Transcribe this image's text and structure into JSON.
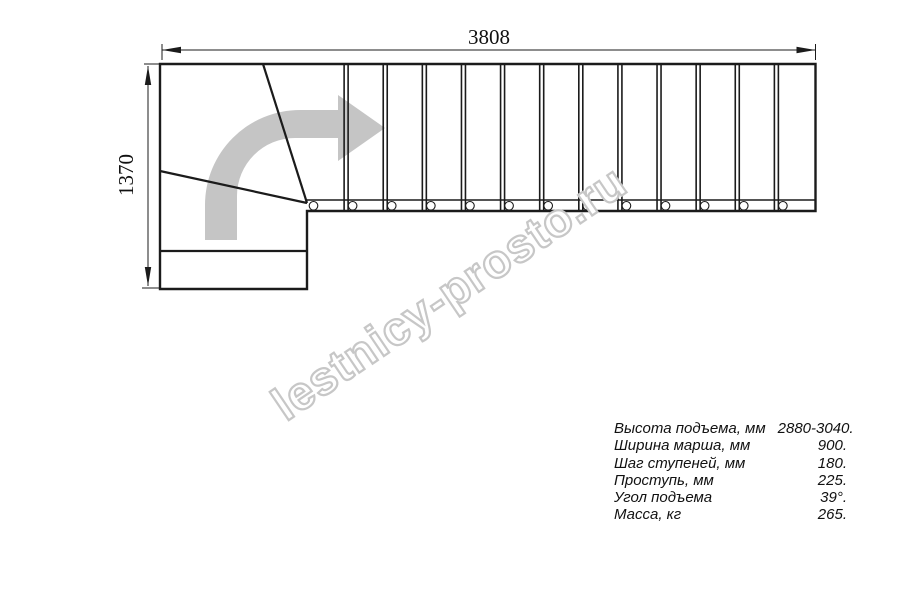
{
  "drawing": {
    "dim_width_label": "3808",
    "dim_height_label": "1370",
    "straight_steps": 13,
    "colors": {
      "line": "#1b1b1b",
      "arrow_fill": "#c5c5c5",
      "watermark_stroke": "#c7c7c7",
      "text": "#111111"
    }
  },
  "watermark": {
    "text": "lestnicy-prosto.ru"
  },
  "specs": {
    "rows": [
      {
        "label": "Высота подъема, мм",
        "value": "2880-3040."
      },
      {
        "label": "Ширина марша, мм",
        "value": "900."
      },
      {
        "label": "Шаг ступеней, мм",
        "value": "180."
      },
      {
        "label": "Проступь, мм",
        "value": "225."
      },
      {
        "label": "Угол подъема",
        "value": "39°."
      },
      {
        "label": "Масса, кг",
        "value": "265."
      }
    ]
  }
}
